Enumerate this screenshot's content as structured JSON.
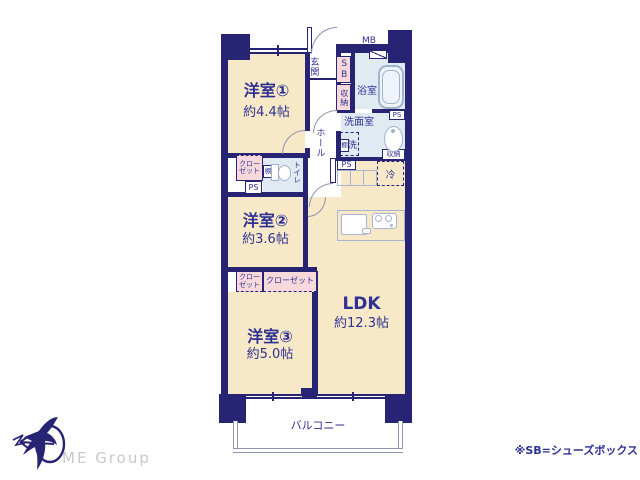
{
  "colors": {
    "wall_navy": "#272473",
    "text_navy": "#2e3192",
    "room_beige": "#f7e9c8",
    "wet_area_blue": "#dfeaf2",
    "closet_pink": "#f7d9dc",
    "balcony_rail": "#8e96b5",
    "fixture_gray": "#a9b4cf",
    "logo_gray": "#c9c9c9"
  },
  "rooms": {
    "yoshitsu1": {
      "name": "洋室①",
      "size": "約4.4帖"
    },
    "yoshitsu2": {
      "name": "洋室②",
      "size": "約3.6帖"
    },
    "yoshitsu3": {
      "name": "洋室③",
      "size": "約5.0帖"
    },
    "ldk": {
      "name": "LDK",
      "size": "約12.3帖"
    },
    "genkan": {
      "name": "玄関"
    },
    "hall": {
      "name": "ホール"
    },
    "bath": {
      "name": "浴室"
    },
    "washroom": {
      "name": "洗面室"
    },
    "toilet": {
      "name": "トイレ"
    },
    "balcony": {
      "name": "バルコニー"
    }
  },
  "fixtures": {
    "shoe_box": "SB",
    "meter_box": "MB",
    "pipe_space": "PS",
    "storage": "収納",
    "shelf": "棚",
    "washing_machine": "洗",
    "refrigerator": "冷",
    "closet": "クローゼット",
    "closet_two_line": "クロー\nゼット"
  },
  "footer": {
    "note": "※SB=シューズボックス",
    "logo_text": "ME Group"
  }
}
